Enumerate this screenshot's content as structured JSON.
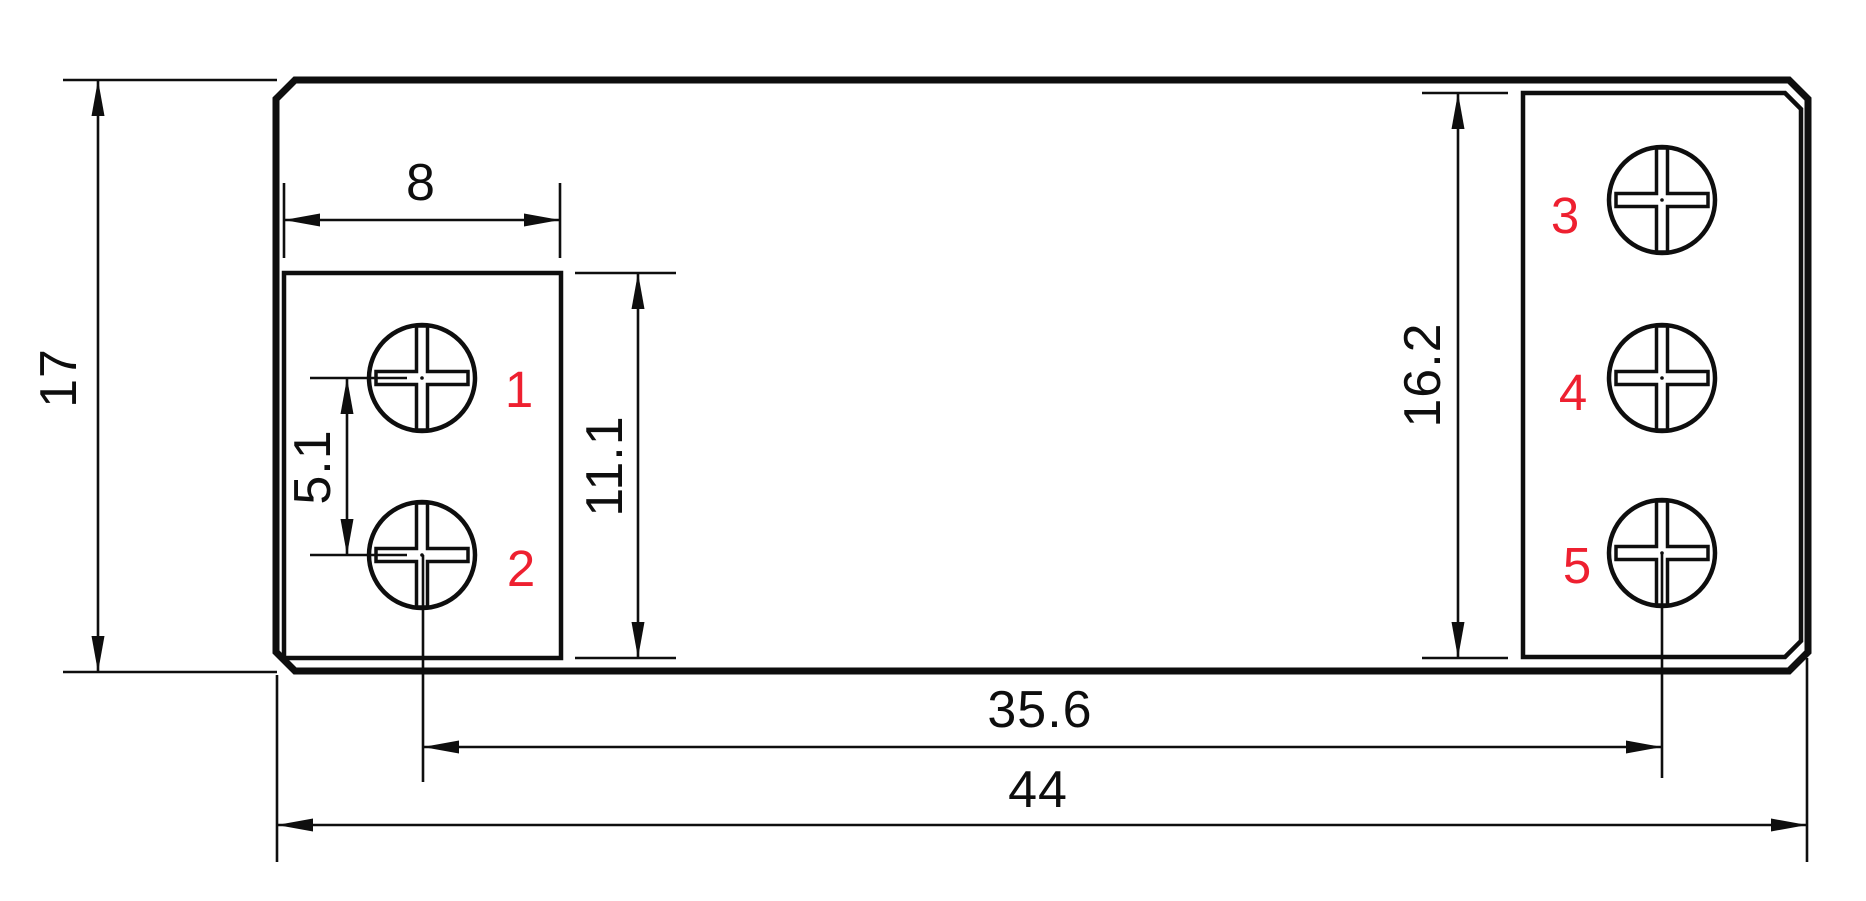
{
  "drawing": {
    "type": "technical-dimension-drawing",
    "description": "Top view of 5-screw terminal device footprint with dimensions",
    "colors": {
      "line": "#0e0e0e",
      "label": "#ee2030",
      "background": "#ffffff"
    },
    "dims": {
      "overall_height": "17",
      "left_pad_width": "8",
      "terminal_pitch": "5.1",
      "left_pad_height": "11.1",
      "right_pad_height": "16.2",
      "terminal_span": "35.6",
      "overall_width": "44"
    },
    "terminals": [
      "1",
      "2",
      "3",
      "4",
      "5"
    ]
  }
}
